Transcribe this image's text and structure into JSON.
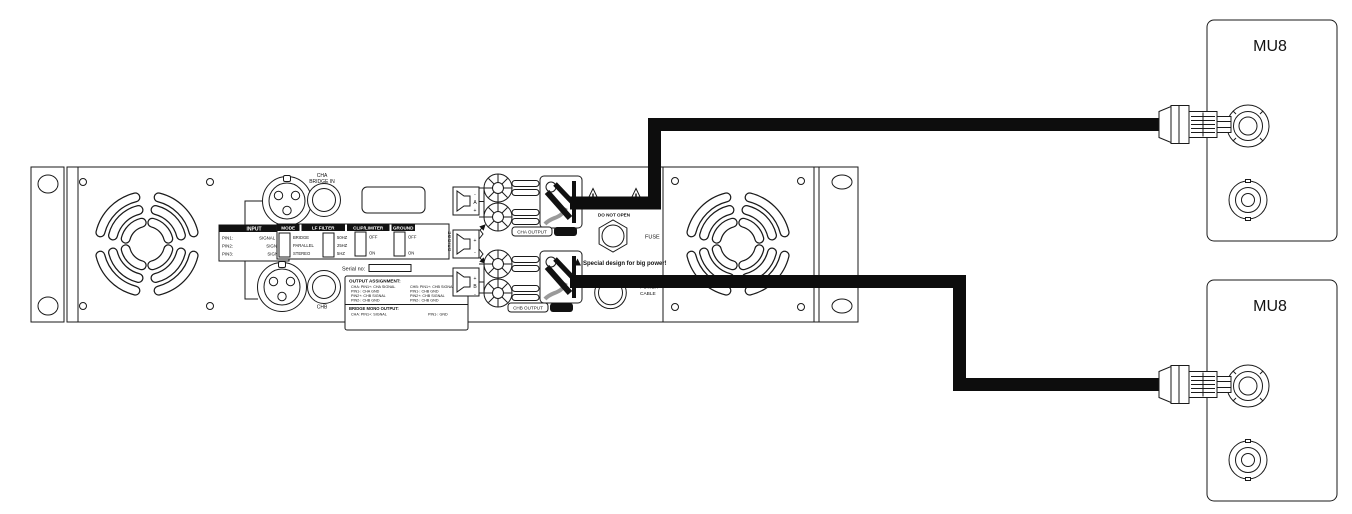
{
  "amp": {
    "labels": {
      "cha_bridge_in_line1": "CHA",
      "cha_bridge_in_line2": "BRIDGE IN",
      "chb": "CHB",
      "serial": "Serial no:",
      "bridge_vertical": "BRIDGE",
      "cha_output": "CHA OUTPUT",
      "chb_output": "CHB OUTPUT",
      "do_not_open": "DO NOT OPEN",
      "fuse": "FUSE",
      "big_power": "Special design for big power!",
      "power_line1": "POWER",
      "power_line2": "CABLE"
    },
    "input_table": {
      "header": "INPUT",
      "rows": [
        {
          "pin": "PIN1:",
          "signal": "SIGNAL GND"
        },
        {
          "pin": "PIN2:",
          "signal": "SIGNAL +"
        },
        {
          "pin": "PIN3:",
          "signal": "SIGNAL -"
        }
      ]
    },
    "switch_table": {
      "mode": {
        "header": "MODE",
        "options": [
          "BRIDGE",
          "PARALLEL",
          "STEREO"
        ]
      },
      "lf_filter": {
        "header": "LF FILTER",
        "options": [
          "50HZ",
          "25HZ",
          "5HZ"
        ]
      },
      "clip_limiter": {
        "header": "CLIP/LIMITER",
        "options": [
          "OFF",
          "ON"
        ]
      },
      "ground": {
        "header": "GROUND",
        "options": [
          "OFF",
          "ON"
        ]
      }
    },
    "output_assignment": {
      "title": "OUTPUT ASSIGNMENT:",
      "col_left": [
        "CHA: PIN1+: CHA SIGNAL",
        "PIN1-: CHA GND",
        "PIN2+: CHB SIGNAL",
        "PIN2-: CHB GND"
      ],
      "col_right": [
        "CHB: PIN1+: CHB SIGNAL",
        "PIN1-: CHB GND",
        "PIN2+: CHB SIGNAL",
        "PIN2-: CHB GND"
      ],
      "bridge_title": "BRIDGE MONO OUTPUT:",
      "bridge_left": "CHA: PIN1+: SIGNAL",
      "bridge_right": "PIN1-: GND"
    },
    "speaker_terminals": {
      "a": {
        "top": "-",
        "label": "A",
        "bottom": "+"
      },
      "mid": {
        "top": "+",
        "bottom": "-"
      },
      "b": {
        "top": "+",
        "label": "B",
        "bottom": "-"
      }
    }
  },
  "speakers": {
    "box1_name": "MU8",
    "box2_name": "MU8"
  }
}
